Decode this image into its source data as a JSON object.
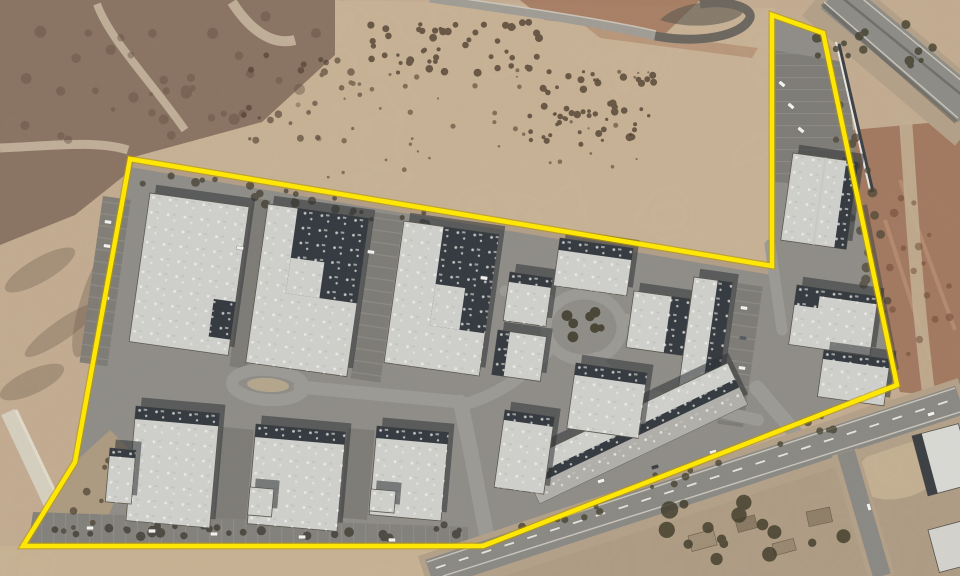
{
  "image": {
    "type": "satellite aerial photograph",
    "subject": "industrial business park outlined with a yellow property-boundary annotation",
    "width": 960,
    "height": 576
  },
  "boundary": {
    "color": "#ffe705",
    "underlay_color": "#b99a00",
    "stroke_width": 4.5,
    "underlay_width": 7,
    "points": "130,159 772,266 772,15 823,33 897,385 483,546 23,546 75,462"
  },
  "palette": {
    "dirt": "#c3ac91",
    "scrub": "#8a7363",
    "asphalt": "#8f8d88",
    "roof": "#cfd0cc",
    "roof_dark": "#343a40",
    "roof_gray": "#b0afaa",
    "roof_edge": "#5a574f",
    "shadow": "#2e3134",
    "tree": "#473f30",
    "car": "#f2f2f0"
  },
  "buildings": [
    {
      "id": "b1",
      "x": 150,
      "y": 193,
      "w": 100,
      "h": 150,
      "rot": 8,
      "dark": [
        [
          78,
          96,
          22,
          38
        ]
      ],
      "light": []
    },
    {
      "id": "b2",
      "x": 268,
      "y": 204,
      "w": 102,
      "h": 160,
      "rot": 8,
      "dark": [
        [
          30,
          0,
          72,
          86
        ]
      ],
      "light": [
        [
          30,
          50,
          34,
          36
        ]
      ]
    },
    {
      "id": "b3",
      "x": 404,
      "y": 221,
      "w": 96,
      "h": 143,
      "rot": 8,
      "dark": [
        [
          40,
          0,
          56,
          100
        ]
      ],
      "light": [
        [
          40,
          58,
          30,
          42
        ]
      ]
    },
    {
      "id": "b4",
      "x": 510,
      "y": 272,
      "w": 43,
      "h": 49,
      "rot": 8,
      "dark": [
        [
          0,
          0,
          43,
          10
        ]
      ],
      "light": []
    },
    {
      "id": "b5",
      "x": 498,
      "y": 330,
      "w": 49,
      "h": 45,
      "rot": 8,
      "dark": [
        [
          0,
          0,
          12,
          45
        ]
      ],
      "light": []
    },
    {
      "id": "b6",
      "x": 560,
      "y": 238,
      "w": 74,
      "h": 48,
      "rot": 8,
      "dark": [
        [
          0,
          0,
          74,
          12
        ]
      ],
      "light": []
    },
    {
      "id": "b7",
      "x": 634,
      "y": 291,
      "w": 57,
      "h": 57,
      "rot": 8,
      "dark": [
        [
          38,
          0,
          19,
          57
        ]
      ],
      "light": []
    },
    {
      "id": "b8a",
      "x": 694,
      "y": 277,
      "w": 39,
      "h": 136,
      "rot": 8,
      "dark": [
        [
          24,
          0,
          15,
          136
        ]
      ],
      "light": []
    },
    {
      "id": "b8b",
      "x": 520,
      "y": 462,
      "w": 230,
      "h": 46,
      "rot": -25.5,
      "dark": [
        [
          0,
          18,
          230,
          9
        ]
      ],
      "gray": [
        [
          0,
          27,
          230,
          19
        ]
      ],
      "light": []
    },
    {
      "id": "b9",
      "x": 505,
      "y": 410,
      "w": 50,
      "h": 78,
      "rot": 8,
      "dark": [
        [
          0,
          0,
          50,
          10
        ]
      ],
      "light": []
    },
    {
      "id": "b10",
      "x": 576,
      "y": 363,
      "w": 72,
      "h": 66,
      "rot": 8,
      "dark": [
        [
          0,
          0,
          72,
          12
        ]
      ],
      "light": []
    },
    {
      "id": "b11",
      "x": 793,
      "y": 153,
      "w": 66,
      "h": 88,
      "rot": 8,
      "dark": [
        [
          54,
          0,
          12,
          88
        ]
      ],
      "ridge": 33,
      "light": []
    },
    {
      "id": "b12",
      "x": 797,
      "y": 285,
      "w": 82,
      "h": 60,
      "rot": 8,
      "dark": [
        [
          0,
          0,
          24,
          20
        ],
        [
          24,
          0,
          58,
          8
        ]
      ],
      "light": []
    },
    {
      "id": "b13",
      "x": 824,
      "y": 350,
      "w": 67,
      "h": 47,
      "rot": 8,
      "dark": [
        [
          0,
          0,
          67,
          9
        ]
      ],
      "light": []
    },
    {
      "id": "b14",
      "x": 136,
      "y": 406,
      "w": 84,
      "h": 115,
      "rot": 5,
      "dark": [
        [
          0,
          0,
          84,
          13
        ]
      ],
      "light": []
    },
    {
      "id": "b14x",
      "x": 110,
      "y": 448,
      "w": 26,
      "h": 54,
      "rot": 5,
      "dark": [
        [
          0,
          0,
          26,
          8
        ]
      ],
      "light": []
    },
    {
      "id": "b15",
      "x": 256,
      "y": 424,
      "w": 90,
      "h": 100,
      "rot": 5,
      "dark": [
        [
          0,
          0,
          90,
          13
        ]
      ],
      "light": []
    },
    {
      "id": "b15x",
      "x": 250,
      "y": 487,
      "w": 24,
      "h": 28,
      "rot": 5,
      "dark": [],
      "light": []
    },
    {
      "id": "b16",
      "x": 377,
      "y": 426,
      "w": 72,
      "h": 89,
      "rot": 5,
      "dark": [
        [
          0,
          0,
          72,
          12
        ]
      ],
      "light": []
    },
    {
      "id": "b16x",
      "x": 371,
      "y": 489,
      "w": 25,
      "h": 22,
      "rot": 5,
      "dark": [],
      "light": []
    }
  ],
  "vegetation": [
    {
      "cx": 170,
      "cy": 80,
      "rx": 150,
      "ry": 65,
      "n": 38,
      "rmin": 2,
      "rmax": 6,
      "color": "#5e4c3f",
      "op": 0.4,
      "seed": 1
    },
    {
      "cx": 455,
      "cy": 48,
      "rx": 85,
      "ry": 26,
      "n": 50,
      "rmin": 1.5,
      "rmax": 4,
      "color": "#4a3a2b",
      "op": 0.75,
      "seed": 2
    },
    {
      "cx": 585,
      "cy": 108,
      "rx": 70,
      "ry": 38,
      "n": 55,
      "rmin": 1.5,
      "rmax": 4,
      "color": "#4a3a2b",
      "op": 0.75,
      "seed": 3
    },
    {
      "cx": 490,
      "cy": 125,
      "rx": 165,
      "ry": 55,
      "n": 45,
      "rmin": 1,
      "rmax": 2.8,
      "color": "#55422f",
      "op": 0.6,
      "seed": 4
    },
    {
      "cx": 300,
      "cy": 100,
      "rx": 60,
      "ry": 45,
      "n": 25,
      "rmin": 1.5,
      "rmax": 4,
      "color": "#4a3a2b",
      "op": 0.6,
      "seed": 12
    },
    {
      "cx": 285,
      "cy": 198,
      "rx": 150,
      "ry": 10,
      "n": 24,
      "rmin": 2,
      "rmax": 4.5,
      "color": "#3f3a2c",
      "op": 0.7,
      "seed": 5,
      "slopeY": 0.165
    },
    {
      "cx": 250,
      "cy": 531,
      "rx": 215,
      "ry": 7,
      "n": 30,
      "rmin": 2.5,
      "rmax": 5,
      "color": "#37332a",
      "op": 0.7,
      "seed": 6
    },
    {
      "cx": 755,
      "cy": 532,
      "rx": 105,
      "ry": 30,
      "n": 16,
      "rmin": 4,
      "rmax": 9,
      "color": "#3e3a28",
      "op": 0.8,
      "seed": 7
    },
    {
      "cx": 885,
      "cy": 42,
      "rx": 70,
      "ry": 26,
      "n": 15,
      "rmin": 2.5,
      "rmax": 5,
      "color": "#43402f",
      "op": 0.8,
      "seed": 8
    },
    {
      "cx": 866,
      "cy": 228,
      "rx": 14,
      "ry": 128,
      "n": 20,
      "rmin": 2.5,
      "rmax": 5,
      "color": "#4a4433",
      "op": 0.7,
      "seed": 9,
      "slantX": 0.2
    },
    {
      "cx": 584,
      "cy": 327,
      "rx": 18,
      "ry": 15,
      "n": 7,
      "rmin": 3,
      "rmax": 6,
      "color": "#3f3a2a",
      "op": 0.85,
      "seed": 10
    },
    {
      "cx": 920,
      "cy": 275,
      "rx": 32,
      "ry": 85,
      "n": 16,
      "rmin": 2,
      "rmax": 4.5,
      "color": "#6b4632",
      "op": 0.5,
      "seed": 11
    },
    {
      "cx": 560,
      "cy": 518,
      "rx": 40,
      "ry": 9,
      "n": 6,
      "rmin": 2,
      "rmax": 4,
      "color": "#3e3a28",
      "op": 0.7,
      "seed": 13,
      "slopeY": -0.3
    },
    {
      "cx": 688,
      "cy": 473,
      "rx": 40,
      "ry": 9,
      "n": 6,
      "rmin": 2,
      "rmax": 4,
      "color": "#3e3a28",
      "op": 0.7,
      "seed": 14,
      "slopeY": -0.3
    },
    {
      "cx": 815,
      "cy": 428,
      "rx": 38,
      "ry": 9,
      "n": 6,
      "rmin": 2,
      "rmax": 4,
      "color": "#3e3a28",
      "op": 0.7,
      "seed": 15,
      "slopeY": -0.3
    },
    {
      "cx": 88,
      "cy": 498,
      "rx": 16,
      "ry": 42,
      "n": 9,
      "rmin": 2,
      "rmax": 4,
      "color": "#4a4030",
      "op": 0.7,
      "seed": 16,
      "slantX": -0.4
    }
  ],
  "vehicles": [
    [
      108,
      222,
      8
    ],
    [
      107,
      246,
      8
    ],
    [
      106,
      298,
      8
    ],
    [
      240,
      248,
      8
    ],
    [
      371,
      252,
      8
    ],
    [
      484,
      278,
      8
    ],
    [
      90,
      528,
      0
    ],
    [
      152,
      531,
      0
    ],
    [
      214,
      534,
      0
    ],
    [
      302,
      537,
      0
    ],
    [
      392,
      540,
      0
    ],
    [
      782,
      84,
      40
    ],
    [
      791,
      106,
      40
    ],
    [
      801,
      130,
      40
    ],
    [
      744,
      308,
      8
    ],
    [
      743,
      338,
      8,
      "#555a60"
    ],
    [
      742,
      368,
      8
    ],
    [
      601,
      481,
      -17
    ],
    [
      713,
      452,
      -17
    ],
    [
      655,
      467,
      -17,
      "#3a3d42"
    ],
    [
      931,
      414,
      -17
    ],
    [
      869,
      507,
      73
    ]
  ]
}
